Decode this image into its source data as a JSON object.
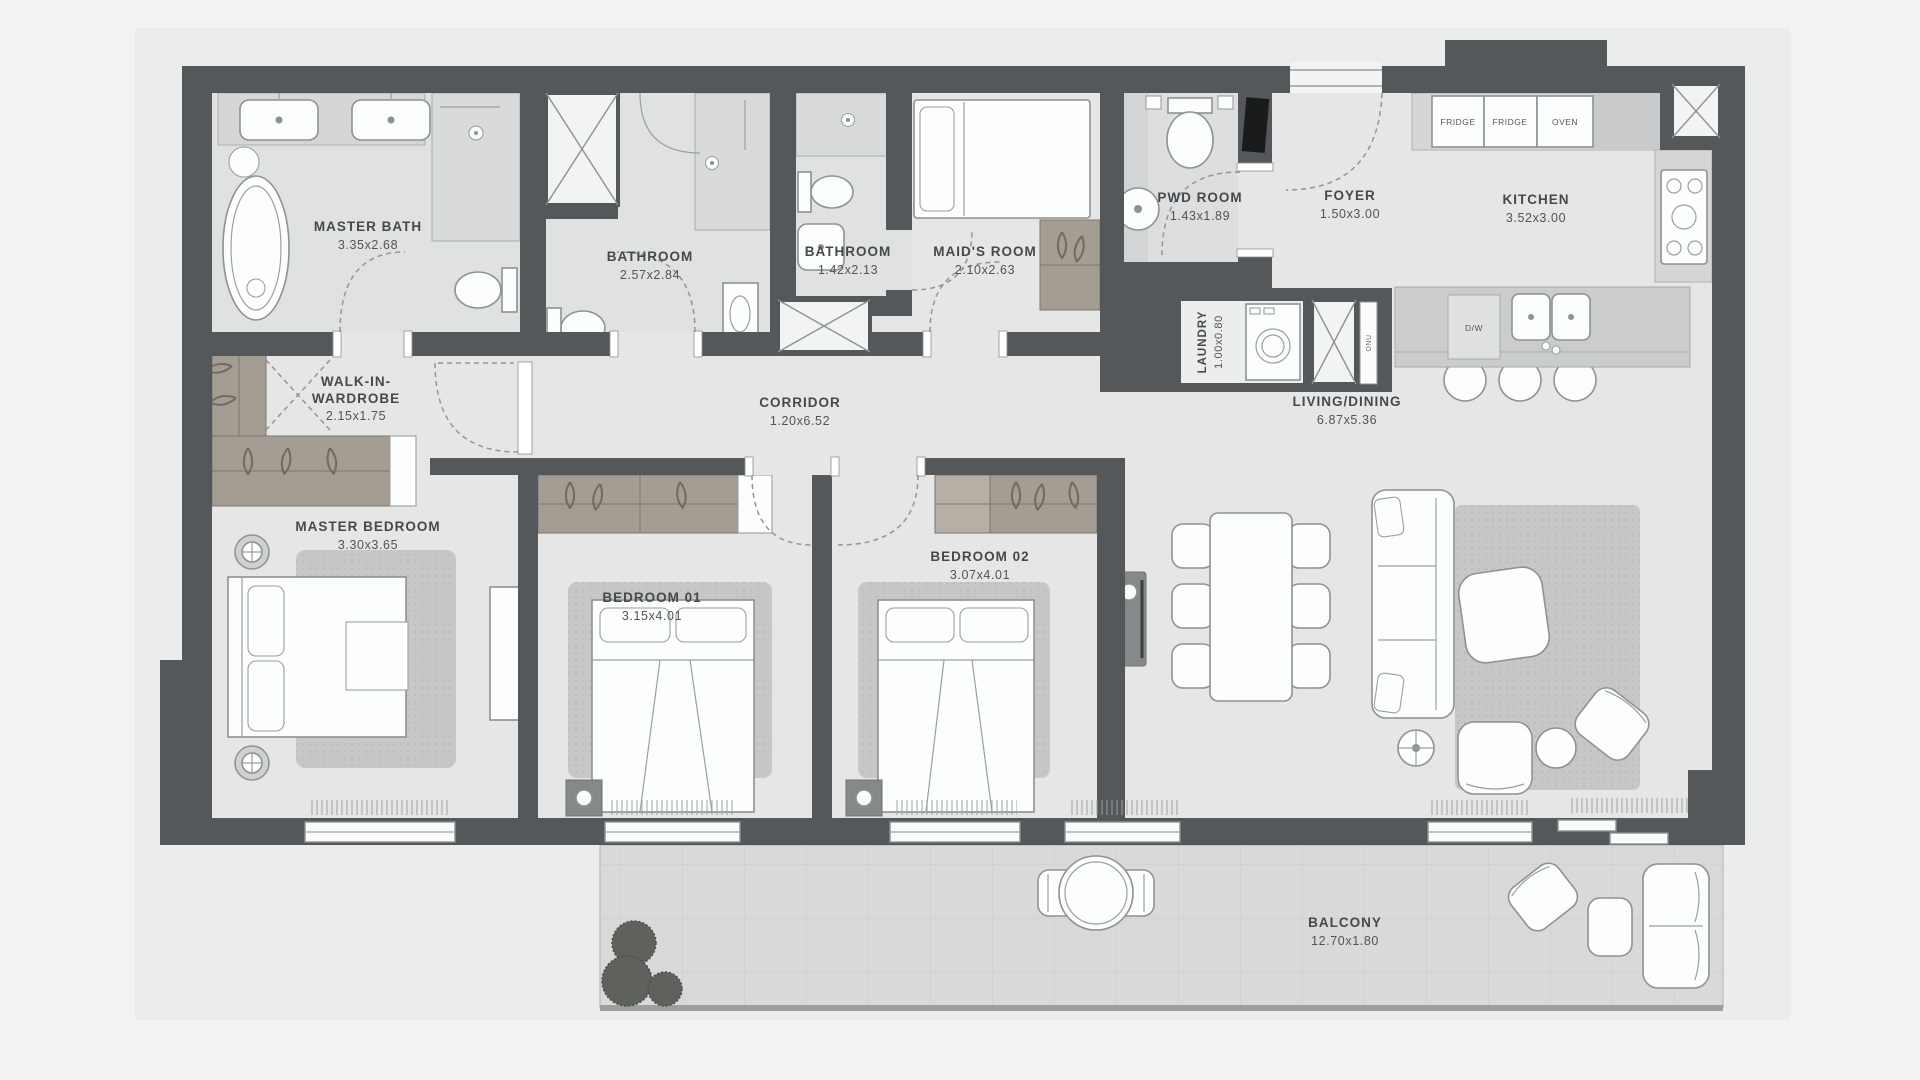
{
  "rooms": [
    {
      "id": "master-bath",
      "name": "MASTER BATH",
      "dims": "3.35x2.68"
    },
    {
      "id": "bathroom-1",
      "name": "BATHROOM",
      "dims": "2.57x2.84"
    },
    {
      "id": "bathroom-2",
      "name": "BATHROOM",
      "dims": "1.42x2.13"
    },
    {
      "id": "maids-room",
      "name": "MAID'S ROOM",
      "dims": "2.10x2.63"
    },
    {
      "id": "pwd-room",
      "name": "PWD ROOM",
      "dims": "1.43x1.89"
    },
    {
      "id": "foyer",
      "name": "FOYER",
      "dims": "1.50x3.00"
    },
    {
      "id": "kitchen",
      "name": "KITCHEN",
      "dims": "3.52x3.00"
    },
    {
      "id": "laundry",
      "name": "LAUNDRY",
      "dims": "1.00x0.80"
    },
    {
      "id": "walk-in-wardrobe",
      "name": "WALK-IN-WARDROBE",
      "line1": "WALK-IN-",
      "line2": "WARDROBE",
      "dims": "2.15x1.75"
    },
    {
      "id": "corridor",
      "name": "CORRIDOR",
      "dims": "1.20x6.52"
    },
    {
      "id": "living-dining",
      "name": "LIVING/DINING",
      "dims": "6.87x5.36"
    },
    {
      "id": "master-bedroom",
      "name": "MASTER BEDROOM",
      "dims": "3.30x3.65"
    },
    {
      "id": "bedroom-01",
      "name": "BEDROOM 01",
      "dims": "3.15x4.01"
    },
    {
      "id": "bedroom-02",
      "name": "BEDROOM 02",
      "dims": "3.07x4.01"
    },
    {
      "id": "balcony",
      "name": "BALCONY",
      "dims": "12.70x1.80"
    }
  ],
  "appliances": {
    "fridge_1": "FRIDGE",
    "fridge_2": "FRIDGE",
    "oven": "OVEN",
    "dishwasher": "D/W",
    "telecom_closet": "ONU"
  },
  "colors": {
    "background": "#f1f2f1",
    "wall": "#55585b",
    "floor": "#e5e6e5",
    "bathroom_floor": "#e0e1e1",
    "counter": "#d5d6d5",
    "wardrobe_wood": "#a39d94",
    "rug": "#c6c7c6",
    "balcony_floor": "#d8d9d8",
    "label_text": "#46494c"
  }
}
